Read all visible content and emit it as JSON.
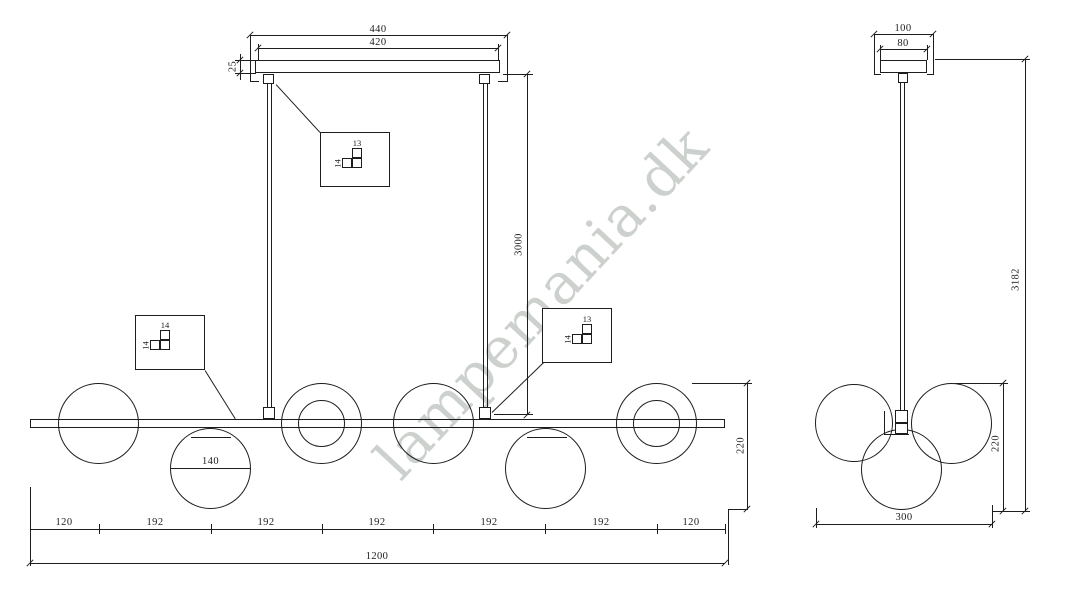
{
  "watermark": {
    "text": "lampemania.dk"
  },
  "colors": {
    "line": "#1d1d1d",
    "watermark": "#ccd1cd",
    "background": "#ffffff"
  },
  "front_view": {
    "canopy_width_outer": "440",
    "canopy_width_inner": "420",
    "canopy_height": "25",
    "rod_length": "3000",
    "sphere_diameter": "140",
    "fixture_height": "220",
    "spacing_segments": [
      "120",
      "192",
      "192",
      "192",
      "192",
      "192",
      "120"
    ],
    "total_length": "1200",
    "detail_callouts": [
      {
        "part_top": "13",
        "part_side": "14"
      },
      {
        "part_top": "14",
        "part_side": "14"
      },
      {
        "part_top": "13",
        "part_side": "14"
      }
    ]
  },
  "side_view": {
    "canopy_width_outer": "100",
    "canopy_width_inner": "80",
    "total_height": "3182",
    "fixture_height": "220",
    "fixture_width": "300"
  }
}
